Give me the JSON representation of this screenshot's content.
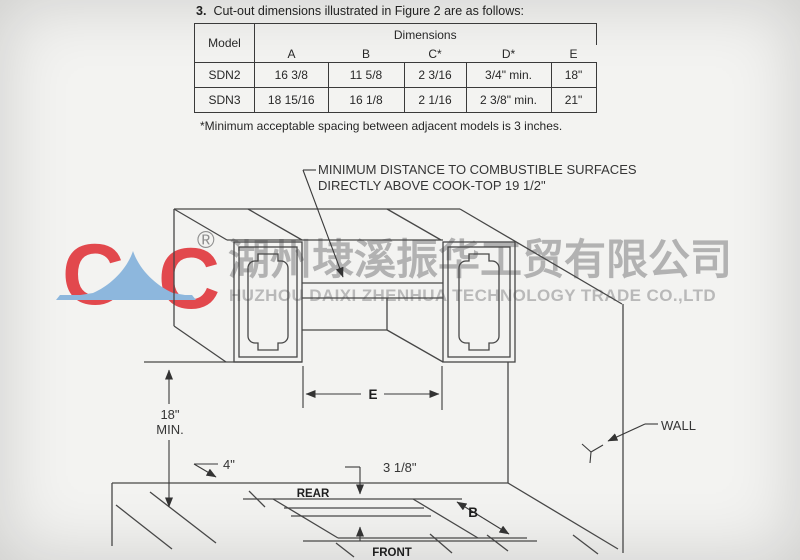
{
  "heading": {
    "number": "3.",
    "text": "Cut-out dimensions illustrated in Figure 2 are as follows:"
  },
  "table": {
    "model_header": "Model",
    "dimensions_header": "Dimensions",
    "columns": [
      "A",
      "B",
      "C*",
      "D*",
      "E"
    ],
    "rows": [
      {
        "model": "SDN2",
        "a": "16 3/8",
        "b": "11 5/8",
        "c": "2 3/16",
        "d": "3/4\" min.",
        "e": "18\""
      },
      {
        "model": "SDN3",
        "a": "18 15/16",
        "b": "16 1/8",
        "c": "2 1/16",
        "d": "2 3/8\" min.",
        "e": "21\""
      }
    ],
    "footnote": "*Minimum acceptable spacing between adjacent models is 3 inches."
  },
  "callout": {
    "line1": "MINIMUM DISTANCE TO COMBUSTIBLE SURFACES",
    "line2": "DIRECTLY ABOVE COOK-TOP 19 1/2\""
  },
  "labels": {
    "dim_e": "E",
    "dim_b": "B",
    "min18_line1": "18\"",
    "min18_line2": "MIN.",
    "dim_4": "4\"",
    "dim_3_1_8": "3 1/8\"",
    "rear": "REAR",
    "front": "FRONT",
    "wall": "WALL"
  },
  "watermark": {
    "logo_letter_1": "C",
    "logo_letter_2": "C",
    "registered_mark": "®",
    "chinese_name": "湖州埭溪振华工贸有限公司",
    "english_name": "HUZHOU DAIXI ZHENHUA TECHNOLOGY TRADE CO.,LTD",
    "red": "#e2484d",
    "blue": "#8db7dd",
    "gray": "#b2b2b2"
  }
}
